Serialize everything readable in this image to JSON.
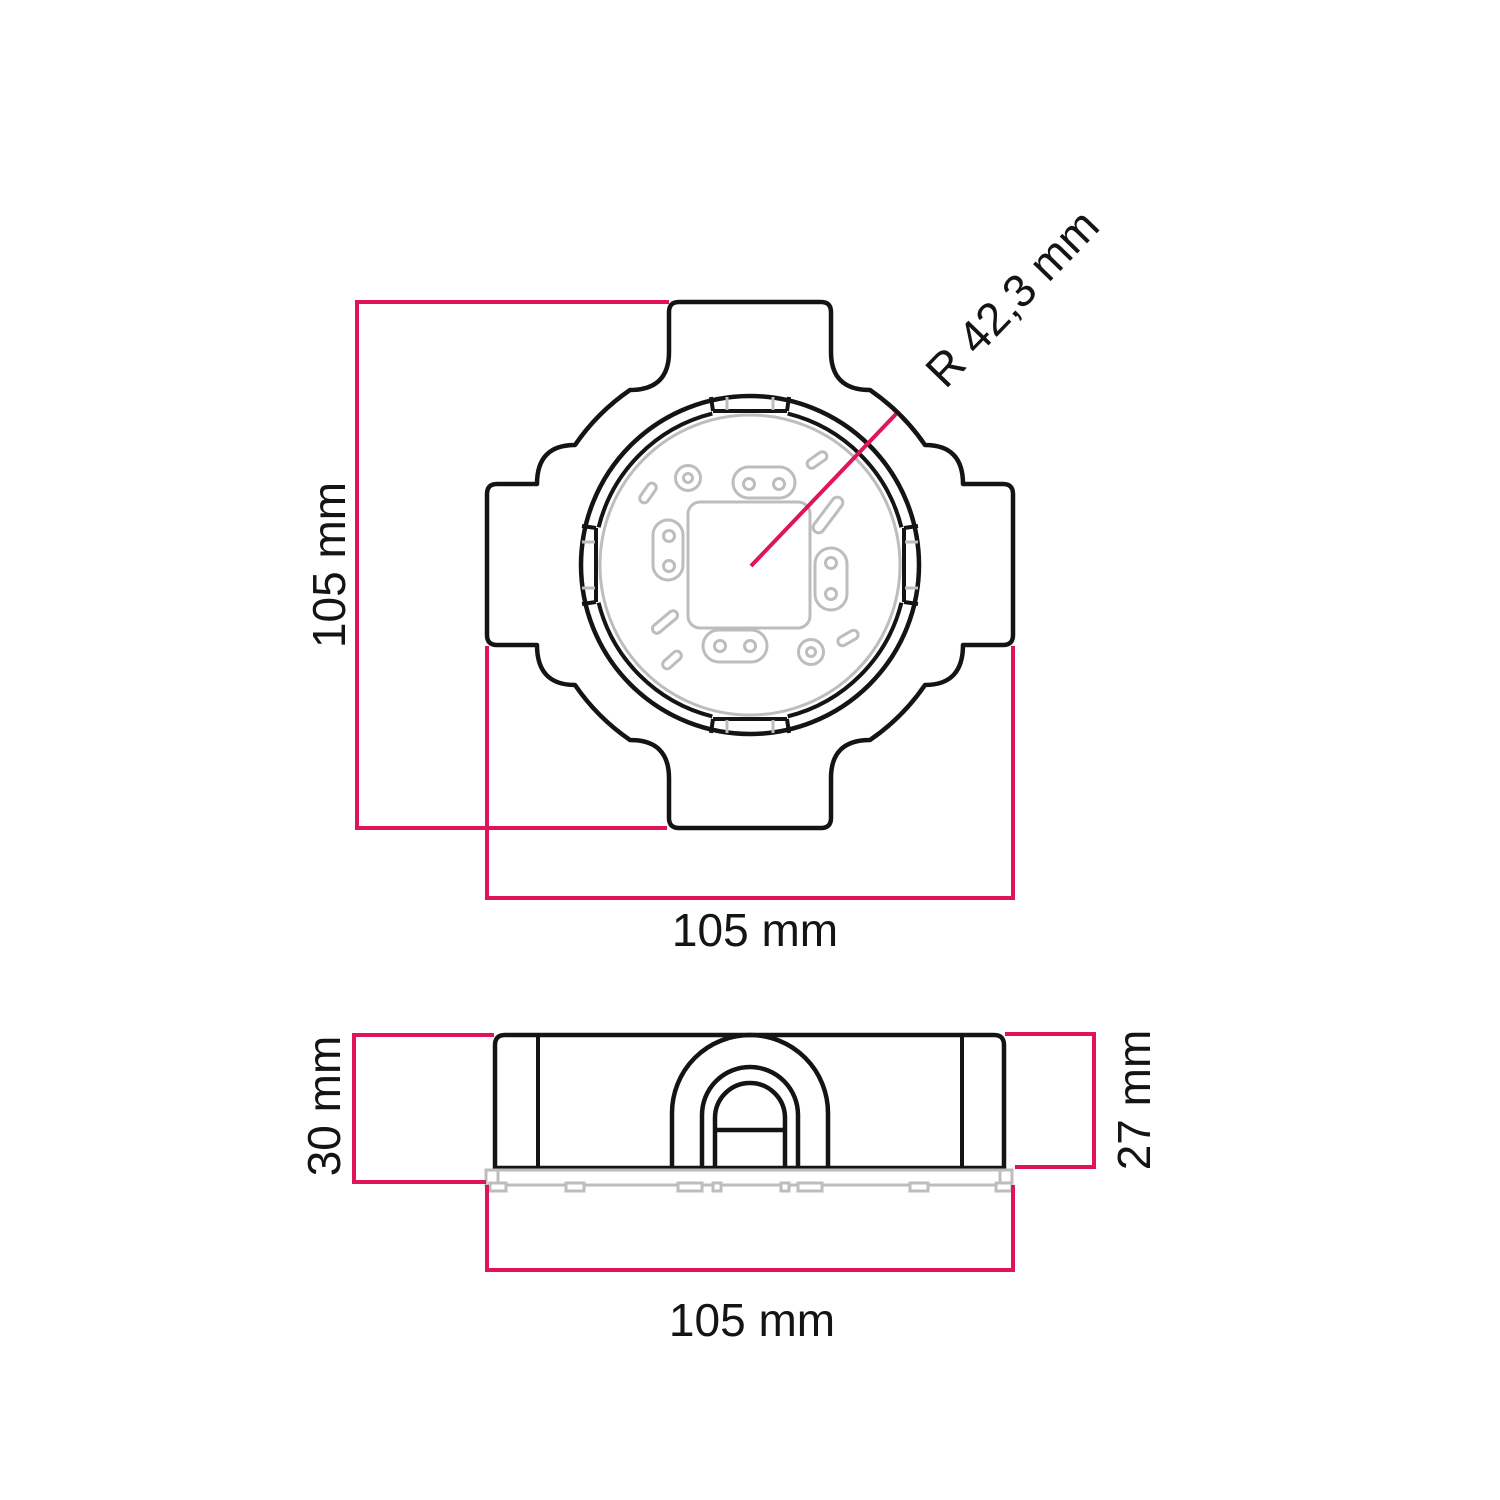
{
  "drawing": {
    "colors": {
      "outline": "#141414",
      "dimension_line": "#e0145a",
      "inner_detail": "#bdbdbd",
      "background": "#ffffff"
    },
    "top_view": {
      "height_label": "105 mm",
      "width_label": "105 mm",
      "radius_label": "R 42,3 mm"
    },
    "side_view": {
      "total_height_label": "30 mm",
      "body_height_label": "27 mm",
      "width_label": "105 mm"
    }
  }
}
